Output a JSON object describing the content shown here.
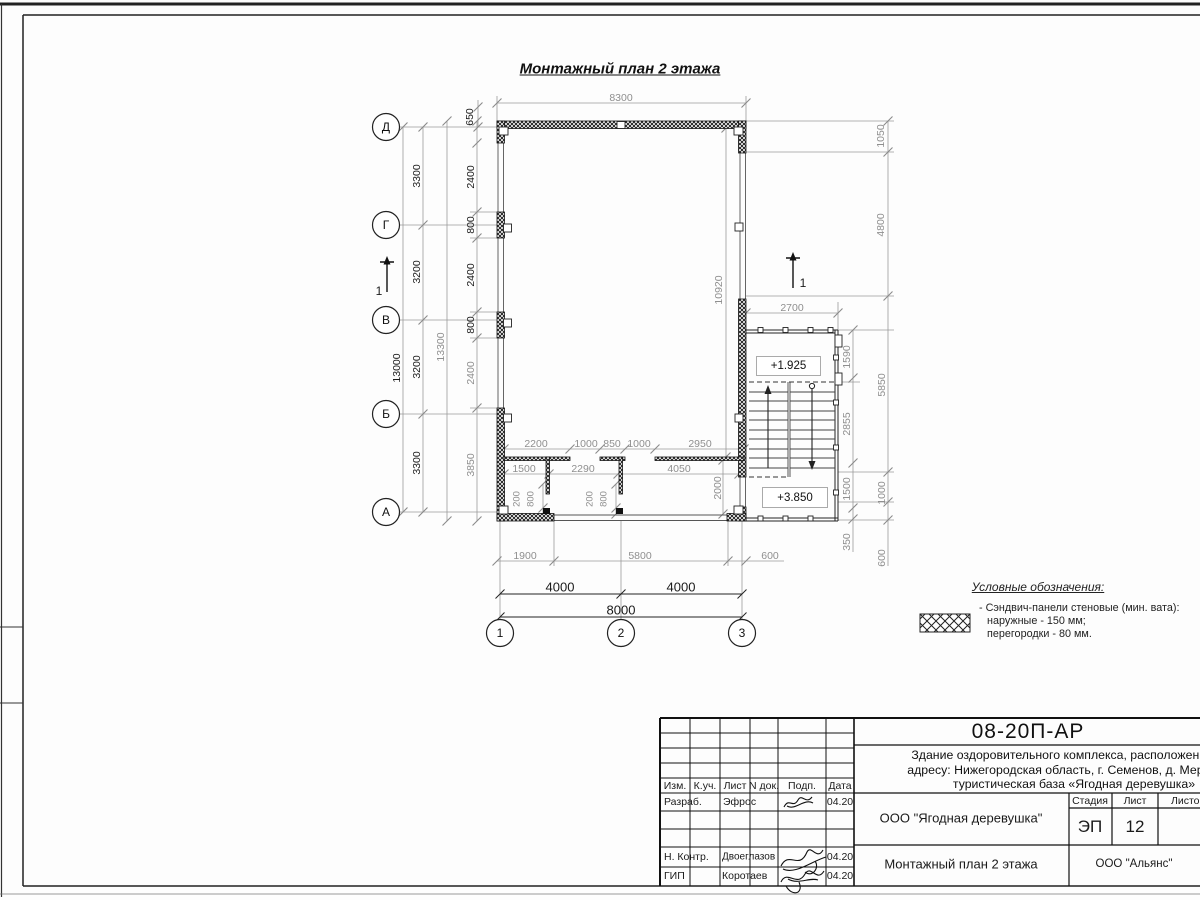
{
  "plan": {
    "title": "Монтажный план 2 этажа",
    "elevations": {
      "upper": "+1.925",
      "lower": "+3.850"
    },
    "section_label": "1",
    "axes": {
      "rows": [
        {
          "label": "Д",
          "x": 386,
          "y": 127
        },
        {
          "label": "Г",
          "x": 386,
          "y": 225
        },
        {
          "label": "В",
          "x": 386,
          "y": 320
        },
        {
          "label": "Б",
          "x": 386,
          "y": 414
        },
        {
          "label": "А",
          "x": 386,
          "y": 512
        }
      ],
      "cols": [
        {
          "label": "1",
          "x": 500,
          "y": 633
        },
        {
          "label": "2",
          "x": 621,
          "y": 633
        },
        {
          "label": "3",
          "x": 742,
          "y": 633
        }
      ]
    },
    "dims": [
      {
        "t": "8300",
        "x": 621,
        "y": 98,
        "r": 0,
        "c": "g"
      },
      {
        "t": "650",
        "x": 470,
        "y": 117,
        "r": 1,
        "c": "b"
      },
      {
        "t": "3300",
        "x": 417,
        "y": 176,
        "r": 1,
        "c": "b"
      },
      {
        "t": "3200",
        "x": 417,
        "y": 272,
        "r": 1,
        "c": "b"
      },
      {
        "t": "3200",
        "x": 417,
        "y": 367,
        "r": 1,
        "c": "b"
      },
      {
        "t": "3300",
        "x": 417,
        "y": 463,
        "r": 1,
        "c": "b"
      },
      {
        "t": "13000",
        "x": 397,
        "y": 368,
        "r": 1,
        "c": "b"
      },
      {
        "t": "13300",
        "x": 441,
        "y": 347,
        "r": 1,
        "c": "g"
      },
      {
        "t": "2400",
        "x": 471,
        "y": 177,
        "r": 1,
        "c": "b"
      },
      {
        "t": "800",
        "x": 471,
        "y": 225,
        "r": 1,
        "c": "b"
      },
      {
        "t": "2400",
        "x": 471,
        "y": 275,
        "r": 1,
        "c": "b"
      },
      {
        "t": "800",
        "x": 471,
        "y": 325,
        "r": 1,
        "c": "b"
      },
      {
        "t": "2400",
        "x": 471,
        "y": 373,
        "r": 1,
        "c": "g"
      },
      {
        "t": "3850",
        "x": 471,
        "y": 465,
        "r": 1,
        "c": "g"
      },
      {
        "t": "1050",
        "x": 881,
        "y": 136,
        "r": 1,
        "c": "g"
      },
      {
        "t": "4800",
        "x": 881,
        "y": 225,
        "r": 1,
        "c": "g"
      },
      {
        "t": "2700",
        "x": 792,
        "y": 308,
        "r": 0,
        "c": "g"
      },
      {
        "t": "1590",
        "x": 847,
        "y": 357,
        "r": 1,
        "c": "g"
      },
      {
        "t": "2855",
        "x": 847,
        "y": 424,
        "r": 1,
        "c": "g"
      },
      {
        "t": "5850",
        "x": 882,
        "y": 385,
        "r": 1,
        "c": "g"
      },
      {
        "t": "1500",
        "x": 847,
        "y": 489,
        "r": 1,
        "c": "g"
      },
      {
        "t": "350",
        "x": 847,
        "y": 542,
        "r": 1,
        "c": "g"
      },
      {
        "t": "1000",
        "x": 882,
        "y": 493,
        "r": 1,
        "c": "g"
      },
      {
        "t": "600",
        "x": 882,
        "y": 558,
        "r": 1,
        "c": "g"
      },
      {
        "t": "10920",
        "x": 719,
        "y": 290,
        "r": 1,
        "c": "g"
      },
      {
        "t": "2200",
        "x": 536,
        "y": 444,
        "r": 0,
        "c": "g"
      },
      {
        "t": "1000",
        "x": 586,
        "y": 444,
        "r": 0,
        "c": "g"
      },
      {
        "t": "850",
        "x": 612,
        "y": 444,
        "r": 0,
        "c": "g"
      },
      {
        "t": "1000",
        "x": 639,
        "y": 444,
        "r": 0,
        "c": "g"
      },
      {
        "t": "2950",
        "x": 700,
        "y": 444,
        "r": 0,
        "c": "g"
      },
      {
        "t": "1500",
        "x": 524,
        "y": 469,
        "r": 0,
        "c": "g"
      },
      {
        "t": "2290",
        "x": 583,
        "y": 469,
        "r": 0,
        "c": "g"
      },
      {
        "t": "4050",
        "x": 679,
        "y": 469,
        "r": 0,
        "c": "g"
      },
      {
        "t": "200",
        "x": 517,
        "y": 499,
        "r": 1,
        "c": "g",
        "s": 9.5
      },
      {
        "t": "800",
        "x": 531,
        "y": 499,
        "r": 1,
        "c": "g",
        "s": 9.5
      },
      {
        "t": "200",
        "x": 590,
        "y": 499,
        "r": 1,
        "c": "g",
        "s": 9.5
      },
      {
        "t": "800",
        "x": 604,
        "y": 499,
        "r": 1,
        "c": "g",
        "s": 9.5
      },
      {
        "t": "2000",
        "x": 718,
        "y": 488,
        "r": 1,
        "c": "g"
      },
      {
        "t": "1900",
        "x": 525,
        "y": 556,
        "r": 0,
        "c": "g"
      },
      {
        "t": "5800",
        "x": 640,
        "y": 556,
        "r": 0,
        "c": "g"
      },
      {
        "t": "600",
        "x": 770,
        "y": 556,
        "r": 0,
        "c": "g"
      },
      {
        "t": "4000",
        "x": 560,
        "y": 588,
        "r": 0,
        "c": "b",
        "s": 13
      },
      {
        "t": "4000",
        "x": 681,
        "y": 588,
        "r": 0,
        "c": "b",
        "s": 13
      },
      {
        "t": "8000",
        "x": 621,
        "y": 611,
        "r": 0,
        "c": "b",
        "s": 13
      },
      {
        "t": "1",
        "x": 379,
        "y": 292,
        "r": 0,
        "c": "b",
        "s": 12
      },
      {
        "t": "1",
        "x": 803,
        "y": 284,
        "r": 0,
        "c": "b",
        "s": 12
      }
    ]
  },
  "legend": {
    "title": "Условные обозначения:",
    "item_line1": "- Сэндвич-панели стеновые (мин. вата):",
    "item_line2": "наружные - 150 мм;",
    "item_line3": "перегородки - 80 мм."
  },
  "titleblock": {
    "doc_code": "08-20П-АР",
    "project_line1": "Здание оздоровительного комплекса, расположенное по",
    "project_line2": "адресу: Нижегородская область, г. Семенов, д. Мериново,",
    "project_line3": "туристическая база «Ягодная деревушка»",
    "client": "ООО \"Ягодная деревушка\"",
    "sheet_title": "Монтажный план 2 этажа",
    "contractor": "ООО \"Альянс\"",
    "stage_label": "Стадия",
    "sheet_label": "Лист",
    "sheets_label": "Листов",
    "stage": "ЭП",
    "sheet_number": "12",
    "cols": {
      "izm": "Изм.",
      "kuch": "К.уч.",
      "list": "Лист",
      "ndok": "N док.",
      "podp": "Подп.",
      "data": "Дата"
    },
    "rows": [
      {
        "role": "Разраб.",
        "name": "Эфрос",
        "date": "04.20"
      },
      {
        "role": "Н. Контр.",
        "name": "Двоеглазов",
        "date": "04.20"
      },
      {
        "role": "ГИП",
        "name": "Коротаев",
        "date": "04.20"
      }
    ]
  }
}
